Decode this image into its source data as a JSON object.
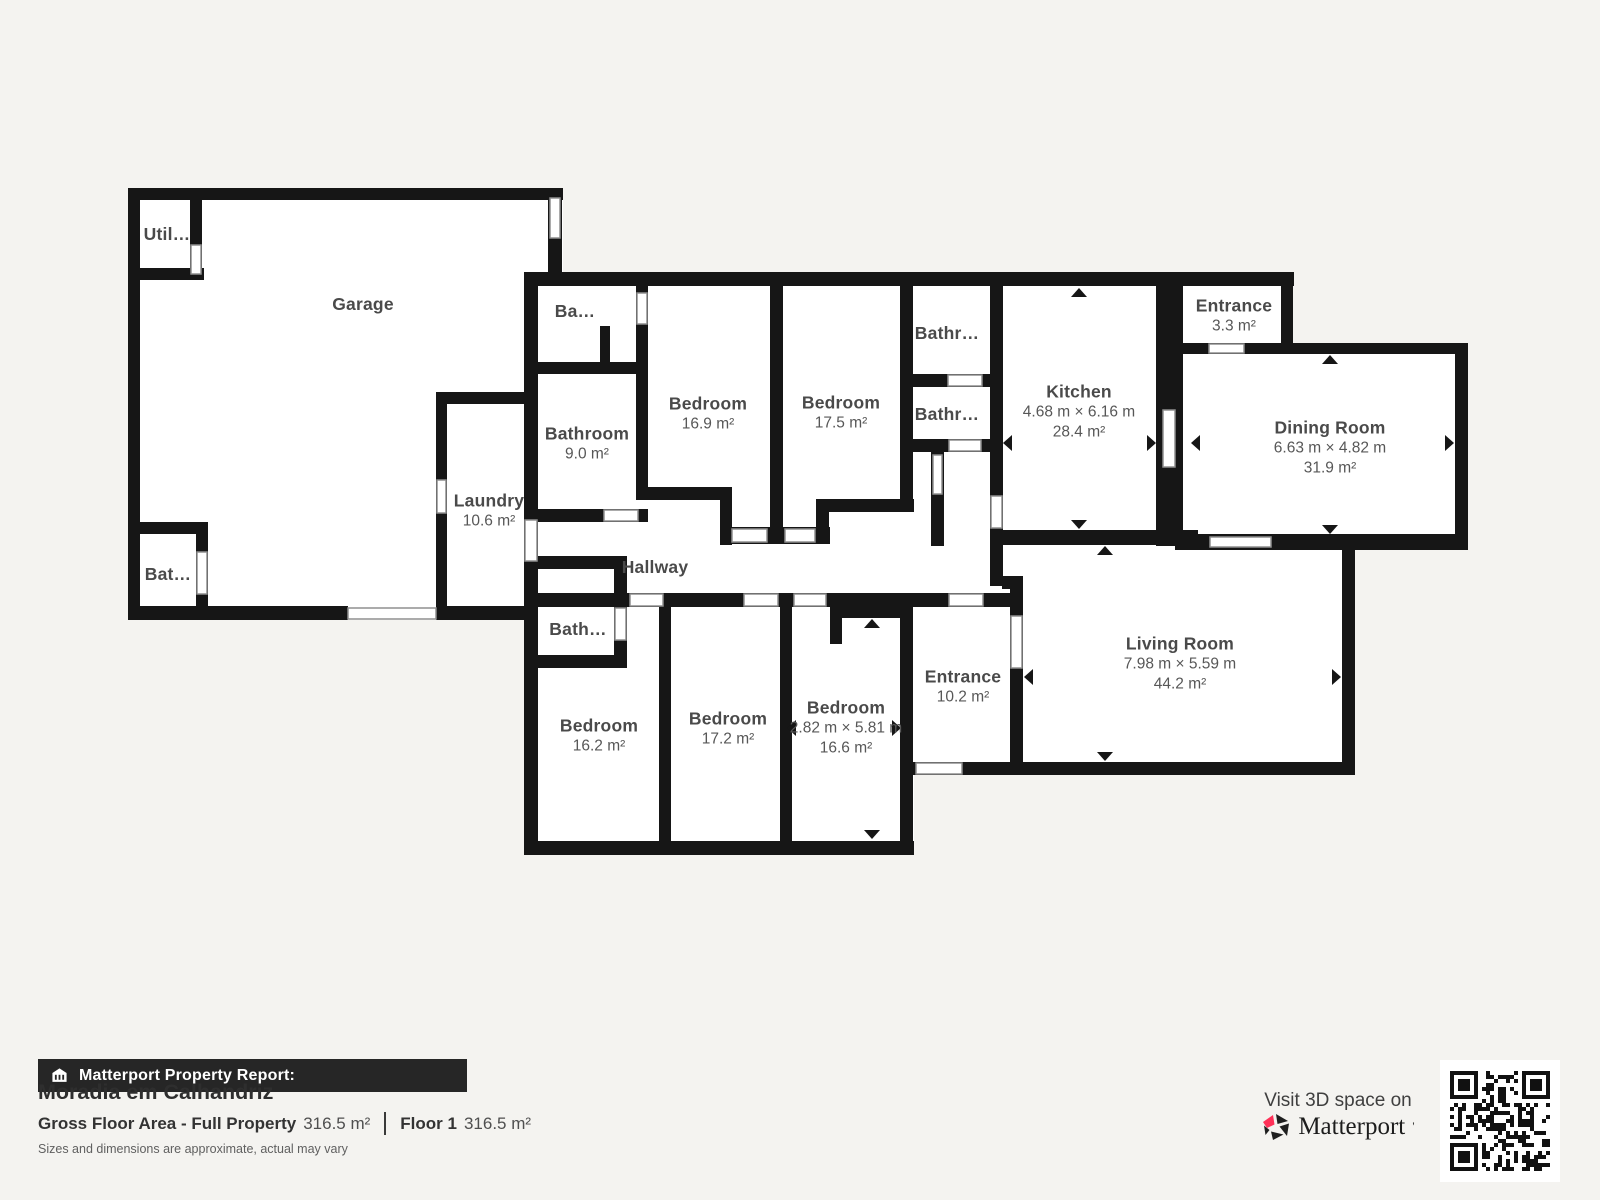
{
  "report": {
    "bar_label": "Matterport Property Report:",
    "property_name": "Moradia em Calhandriz",
    "gross_floor_area_label": "Gross Floor Area - Full Property",
    "gross_floor_area_value": "316.5 m²",
    "floor_label": "Floor 1",
    "floor_value": "316.5 m²",
    "disclaimer": "Sizes and dimensions are approximate, actual may vary"
  },
  "cta": {
    "visit_label": "Visit 3D space on",
    "brand_name": "Matterport"
  },
  "rooms": [
    {
      "id": "garage",
      "name": "Garage"
    },
    {
      "id": "utility",
      "name": "Util…"
    },
    {
      "id": "bat-small",
      "name": "Bat…"
    },
    {
      "id": "ba-small",
      "name": "Ba…"
    },
    {
      "id": "bathroom",
      "name": "Bathroom",
      "area": "9.0 m²"
    },
    {
      "id": "laundry",
      "name": "Laundry",
      "area": "10.6 m²"
    },
    {
      "id": "bedroom-169",
      "name": "Bedroom",
      "area": "16.9 m²"
    },
    {
      "id": "bedroom-175",
      "name": "Bedroom",
      "area": "17.5 m²"
    },
    {
      "id": "bathr-top",
      "name": "Bathr…"
    },
    {
      "id": "bathr-mid",
      "name": "Bathr…"
    },
    {
      "id": "kitchen",
      "name": "Kitchen",
      "dims": "4.68 m × 6.16 m",
      "area": "28.4 m²"
    },
    {
      "id": "entrance-small",
      "name": "Entrance",
      "area": "3.3 m²"
    },
    {
      "id": "dining-room",
      "name": "Dining Room",
      "dims": "6.63 m × 4.82 m",
      "area": "31.9 m²"
    },
    {
      "id": "hallway",
      "name": "Hallway"
    },
    {
      "id": "bath-lower",
      "name": "Bath…"
    },
    {
      "id": "bedroom-162",
      "name": "Bedroom",
      "area": "16.2 m²"
    },
    {
      "id": "bedroom-172",
      "name": "Bedroom",
      "area": "17.2 m²"
    },
    {
      "id": "bedroom-166",
      "name": "Bedroom",
      "dims": "2.82 m × 5.81 m",
      "area": "16.6 m²"
    },
    {
      "id": "entrance-main",
      "name": "Entrance",
      "area": "10.2 m²"
    },
    {
      "id": "living-room",
      "name": "Living Room",
      "dims": "7.98 m × 5.59 m",
      "area": "44.2 m²"
    }
  ],
  "colors": {
    "wall": "#161616",
    "background": "#f4f3f0",
    "room_fill": "#ffffff",
    "label_text": "#4a4a4a",
    "report_bar_bg": "#262626",
    "brand_pink": "#ff3158"
  }
}
